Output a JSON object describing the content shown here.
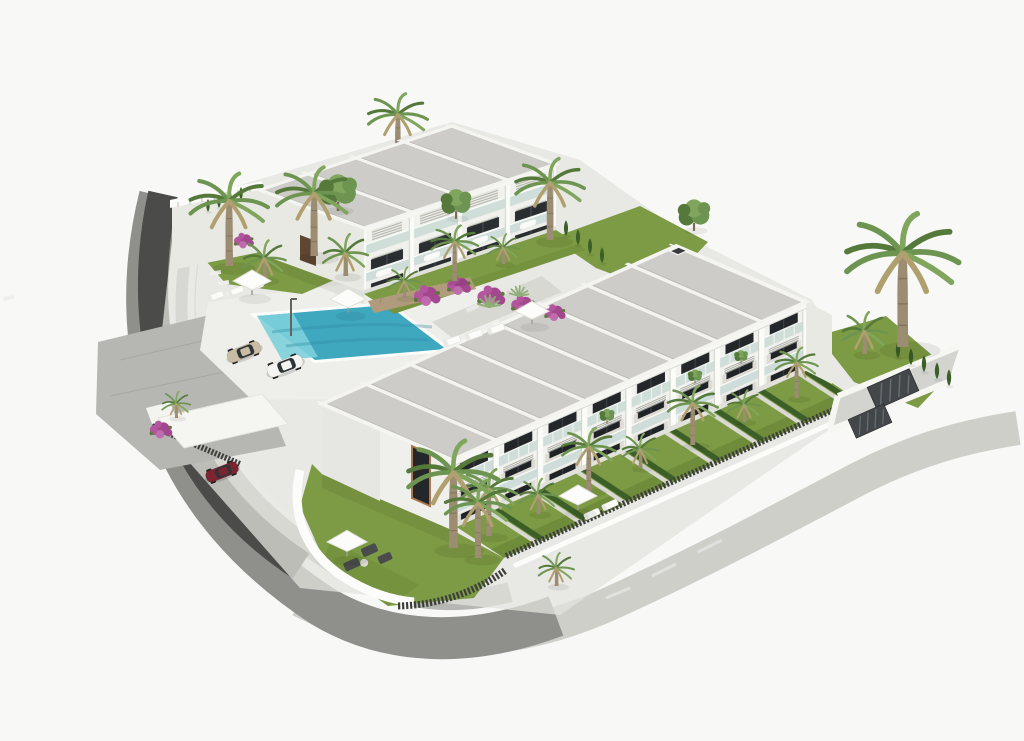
{
  "meta": {
    "title": "Aerial 3D architectural rendering of a modern white townhouse development with pool and palm gardens",
    "canvas": {
      "width": 1024,
      "height": 741
    }
  },
  "scene": {
    "description": "Isometric aerial render on a white background: a three-unit white block (upper left) and a long eight-unit two-storey townhouse row (centre-right) with grey gravel flat roofs divided by white beams, glass balconies, front lawns with cypress hedges and palm trees, a turquoise swimming pool with sun loungers and parasols, a parking area with a beige sedan and a white coupe, a dark-red car under a carport, a dark curved retaining wall and road on the left, paved walkways around the plot, and a large palm tree on the right lawn.",
    "labels": {
      "scene": "architectural site render",
      "buildingA": "three-unit townhouse block",
      "buildingB": "eight-unit townhouse row",
      "roofA": "gravel flat roof with white beams",
      "roofB": "gravel flat roof with white beams",
      "facadeA": "white facade with glass balconies",
      "facadeB": "white facade with glass balconies",
      "pool": "swimming pool",
      "deck": "pool deck",
      "parking": "parking area",
      "carBeige": "beige sedan car",
      "carWhite": "white coupe car",
      "carRed": "dark red car",
      "carport": "white carport canopy",
      "roadLeft": "curved access road",
      "retainingWall": "dark retaining wall",
      "walkway": "perimeter gravel walkway",
      "cornerGarden": "corner lawn garden with parasol and sofas",
      "frontGardens": "private front gardens with hedges",
      "rightLawn": "right side lawn",
      "topGarden": "upper garden",
      "gardenA": "garden strip with bougainvillea",
      "umbrella": "white parasol",
      "lounger": "sun lounger",
      "palm": "palm tree",
      "tree": "leafy tree",
      "cypress": "cypress hedge plant",
      "bougainvillea": "bougainvillea shrub",
      "binGates": "dark louvred utility gates",
      "fence": "dark slat fence",
      "whiteFence": "white fence",
      "shower": "outdoor pool shower",
      "entranceDoor": "timber entrance door",
      "gableWindow": "tall gable window",
      "chimney": "roof vent",
      "stoneWall": "natural stone garden wall",
      "sofaSet": "outdoor sofa set",
      "steppingStones": "stepping stone path",
      "agave": "agave plant",
      "annex": "entrance annex wall"
    },
    "objects": [
      {
        "name": "building",
        "count": 2
      },
      {
        "name": "townhouse-unit",
        "count": 11
      },
      {
        "name": "swimming-pool",
        "count": 1
      },
      {
        "name": "car",
        "count": 3
      },
      {
        "name": "carport",
        "count": 1
      },
      {
        "name": "parasol",
        "count": 5
      },
      {
        "name": "sun-lounger",
        "count": 8
      },
      {
        "name": "palm-tree",
        "count": 22
      },
      {
        "name": "leafy-tree",
        "count": 3
      },
      {
        "name": "bougainvillea-shrub",
        "count": 7
      },
      {
        "name": "utility-gate",
        "count": 2
      },
      {
        "name": "outdoor-shower",
        "count": 1
      },
      {
        "name": "outdoor-sofa-set",
        "count": 1
      }
    ]
  },
  "colors": {
    "bg": "#f8f8f7",
    "roofGravel": "#cac9c4",
    "roofGravelLight": "#d2d1cc",
    "beamWhite": "#f3f3f0",
    "wallWhite": "#f4f4f1",
    "wallShade": "#e9e9e4",
    "windowDark": "#24272a",
    "glass": "#ccdcd9",
    "poolMain": "#3fa8bf",
    "poolLight": "#7ccfda",
    "poolDark": "#2d89a2",
    "deck": "#eeeeea",
    "lawn": "#7d9b44",
    "lawnDark": "#6f8c3b",
    "hedge": "#3c5f27",
    "frond1": "#55793b",
    "frond2": "#6d9450",
    "frond3": "#7fa65c",
    "frondDry": "#b1a06f",
    "trunk": "#9b8c72",
    "roadDark": "#4b4b49",
    "roadMid": "#8f8f8c",
    "paver": "#b6b6b2",
    "walk": "#cfcfca",
    "gravelPale": "#dcdcd8",
    "stone": "#b09c7c",
    "boug1": "#b4569f",
    "boug2": "#a3488f",
    "carBeige": "#c8bda4",
    "carWhite": "#f4f4f2",
    "carRed": "#7c2531",
    "fenceDark": "#3e3f3d",
    "white": "#fcfcfb",
    "sofa": "#4a4c4c"
  }
}
